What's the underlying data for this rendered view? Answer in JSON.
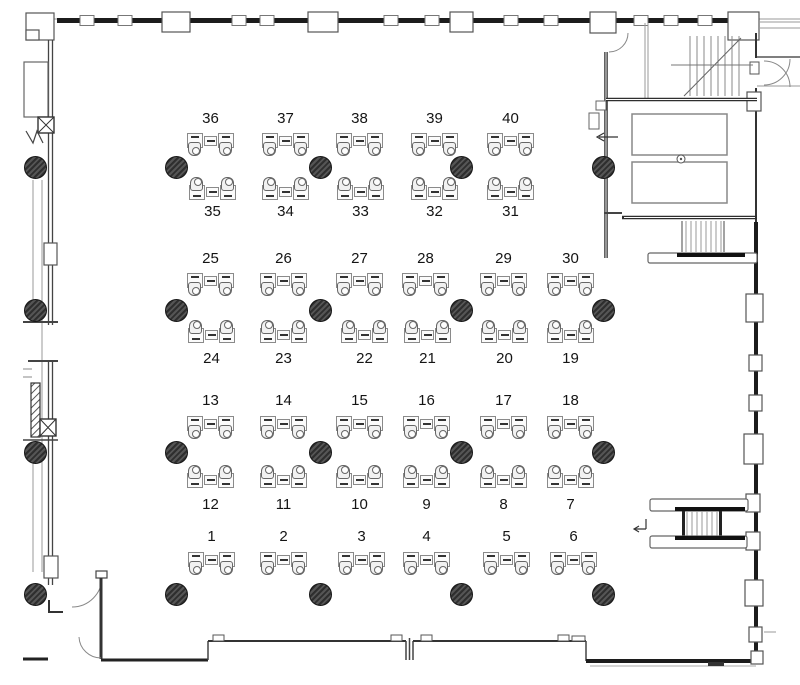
{
  "app": {
    "type": "office-floor-plan"
  },
  "colors": {
    "wall": "#1c1c1c",
    "line": "#6b6b6b",
    "thin": "#9a9a9a",
    "column_fill": "#3d3d3d",
    "desk_fill": "#fbfbfb",
    "label": "#141414",
    "bg": "#ffffff"
  },
  "desks": {
    "rows": [
      {
        "band": 1,
        "side": "top",
        "facing": "down",
        "numbers": [
          "36",
          "37",
          "38",
          "39",
          "40"
        ]
      },
      {
        "band": 1,
        "side": "bottom",
        "facing": "up",
        "numbers": [
          "35",
          "34",
          "33",
          "32",
          "31"
        ]
      },
      {
        "band": 2,
        "side": "top",
        "facing": "down",
        "numbers": [
          "25",
          "26",
          "27",
          "28",
          "29",
          "30"
        ]
      },
      {
        "band": 2,
        "side": "bottom",
        "facing": "up",
        "numbers": [
          "24",
          "23",
          "22",
          "21",
          "20",
          "19"
        ]
      },
      {
        "band": 3,
        "side": "top",
        "facing": "down",
        "numbers": [
          "13",
          "14",
          "15",
          "16",
          "17",
          "18"
        ]
      },
      {
        "band": 3,
        "side": "bottom",
        "facing": "up",
        "numbers": [
          "12",
          "11",
          "10",
          "9",
          "8",
          "7"
        ]
      },
      {
        "band": 4,
        "side": "top",
        "facing": "down",
        "numbers": [
          "1",
          "2",
          "3",
          "4",
          "5",
          "6"
        ]
      }
    ]
  }
}
